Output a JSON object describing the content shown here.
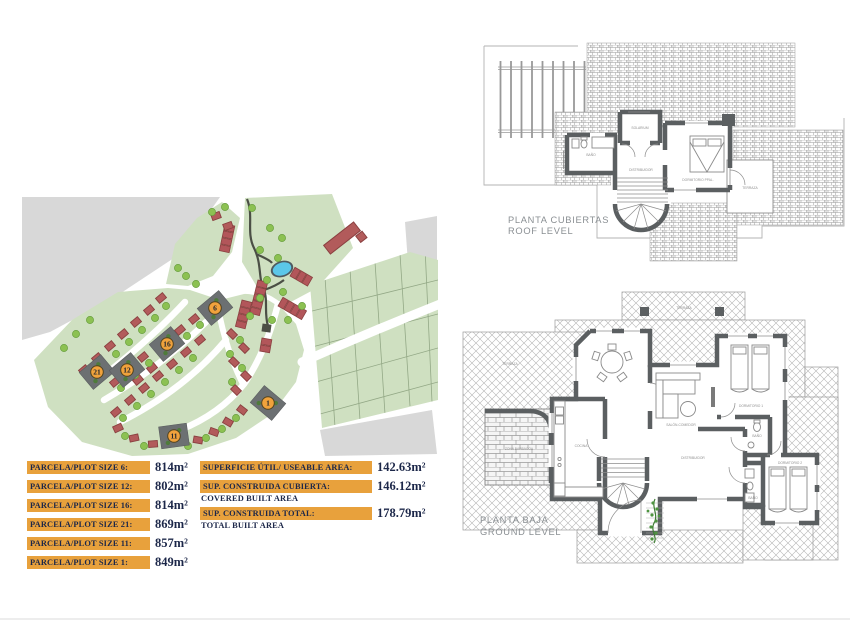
{
  "site_plan": {
    "markers": [
      {
        "id": "6"
      },
      {
        "id": "16"
      },
      {
        "id": "21"
      },
      {
        "id": "12"
      },
      {
        "id": "11"
      },
      {
        "id": "1"
      }
    ],
    "colors": {
      "land_green": "#cfe0c1",
      "ground_gray": "#d8d8d8",
      "house_red": "#b25b5b",
      "house_outline": "#8a4040",
      "selected_plot_gray": "#6c7072",
      "marker_orange": "#f0a23c",
      "pool_blue": "#5bc7e9",
      "tree_green": "#8cc152"
    }
  },
  "plot_table": {
    "rows": [
      {
        "label": "PARCELA/PLOT SIZE 6:",
        "value": "814m²"
      },
      {
        "label": "PARCELA/PLOT SIZE 12:",
        "value": "802m²"
      },
      {
        "label": "PARCELA/PLOT SIZE 16:",
        "value": "814m²"
      },
      {
        "label": "PARCELA/PLOT SIZE 21:",
        "value": "869m²"
      },
      {
        "label": "PARCELA/PLOT SIZE 11:",
        "value": "857m²"
      },
      {
        "label": "PARCELA/PLOT SIZE 1:",
        "value": "849m²"
      }
    ]
  },
  "area_table": {
    "rows": [
      {
        "label": "SUPERFICIE ÚTIL/ USEABLE AREA:",
        "sub": "",
        "value": "142.63m²"
      },
      {
        "label": "SUP. CONSTRUIDA CUBIERTA:",
        "sub": "COVERED BUILT AREA",
        "value": "146.12m²"
      },
      {
        "label": "SUP. CONSTRUIDA TOTAL:",
        "sub": "TOTAL BUILT AREA",
        "value": "178.79m²"
      }
    ]
  },
  "roof_plan": {
    "title_line1": "PLANTA CUBIERTAS",
    "title_line2": "ROOF LEVEL",
    "rooms": [
      "SOLARIUM",
      "BAÑO",
      "DISTRIBUIDOR",
      "DORMITORIO PPAL.",
      "TERRAZA"
    ]
  },
  "ground_plan": {
    "title_line1": "PLANTA BAJA",
    "title_line2": "GROUND LEVEL",
    "rooms": [
      "TERRAZA",
      "TERRAZA",
      "ZONA BARBACOA",
      "COCINA",
      "SALÓN-COMEDOR",
      "DISTRIBUIDOR",
      "DORMITORIO 1",
      "BAÑO",
      "DORMITORIO 2",
      "BAÑO"
    ]
  }
}
